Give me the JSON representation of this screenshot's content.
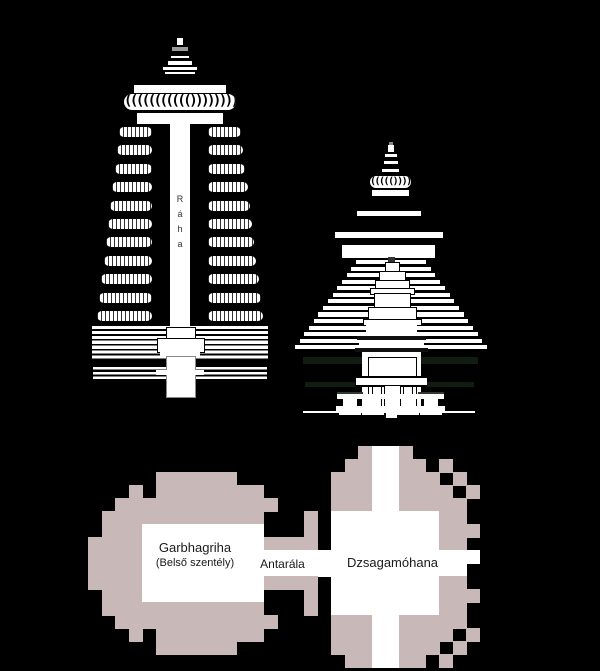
{
  "colors": {
    "background": "#000000",
    "line_art": "#ffffff",
    "plan_wall": "#c8b8b8",
    "plan_room": "#ffffff",
    "label_ink": "#1a1a1a",
    "dark_accent": "#101d10"
  },
  "left_tower": {
    "raha_label": "R\ná\nh\na",
    "amalaka_glyphs": "((((((((((()))))))))))",
    "bhumi_amala_rows": 11
  },
  "right_tower": {
    "amalaka_glyphs": "((((()))))",
    "pidha_tiers": 14
  },
  "plan": {
    "labels": {
      "garbhagriha": "Garbhagriha",
      "garbhagriha_sub": "(Belső szentély)",
      "antarala": "Antarála",
      "jagamohana": "Dzsagamóhana"
    },
    "cell": {
      "w": 13.5,
      "h": 13,
      "x": 88,
      "y": 446
    },
    "grid": [
      "....................XooX.....",
      "...................XXooXX.X..",
      ".....XXXXXX.......XXXooXXX.X.",
      "...X.XXXXXXXX.....XXXooXXXX.X",
      "..XXXXXXXXXXXX....XXXooXXXXX.",
      ".XXXXXXXXXXXX...X.ooooooooXX.",
      ".XXXooooooooo...X.ooooooooXXX",
      "XXXXoooooooooXXXX.ooooooooXX.",
      "XXXXooooooooooooooooooooooooo",
      "XXXXoooooooooooooooooooooooo.",
      "XXXXoooooooooXXXX.ooooooooXX.",
      ".XXXooooooooo...X.ooooooooXXX",
      ".XXXXXXXXXXXX...X.ooooooooXX.",
      "..XXXXXXXXXXXX....XXXooXXXXX.",
      "...X.XXXXXXXX.....XXXooXXXX.X",
      ".....XXXXXX.......XXXooXXX.X.",
      "...................XXooXX.X.."
    ]
  }
}
